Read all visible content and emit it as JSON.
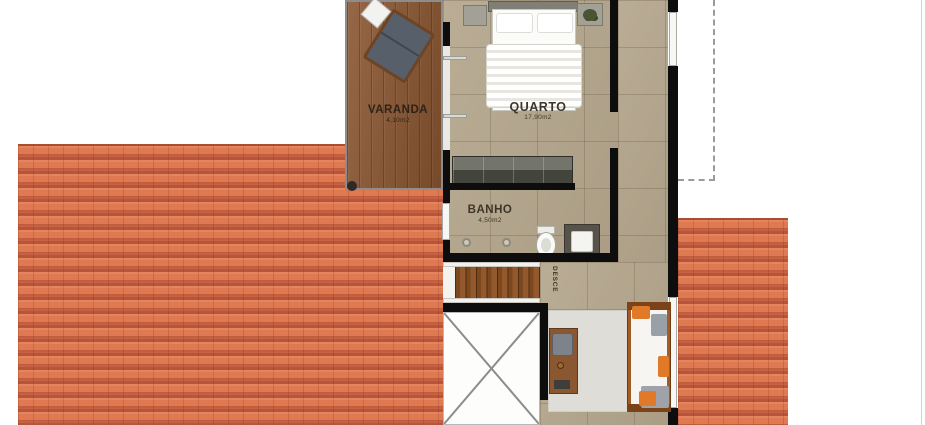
{
  "plan_title": "upper-floor-plan",
  "rooms": {
    "varanda": {
      "label": "VARANDA",
      "area": "4,10m2"
    },
    "quarto": {
      "label": "QUARTO",
      "area": "17,90m2"
    },
    "banho": {
      "label": "BANHO",
      "area": "4,50m2"
    }
  },
  "stairs": {
    "label": "DESCE"
  },
  "colors": {
    "roof_tile": "#DE7951",
    "roof_tile_dark": "#B85437",
    "deck_wood": "#8A5631",
    "floor_tile": "#B5A78D",
    "wall": "#0D0D0D",
    "rug": "#DFDDD7",
    "cushion_orange": "#E07A28",
    "chair_gray": "#57606A"
  }
}
